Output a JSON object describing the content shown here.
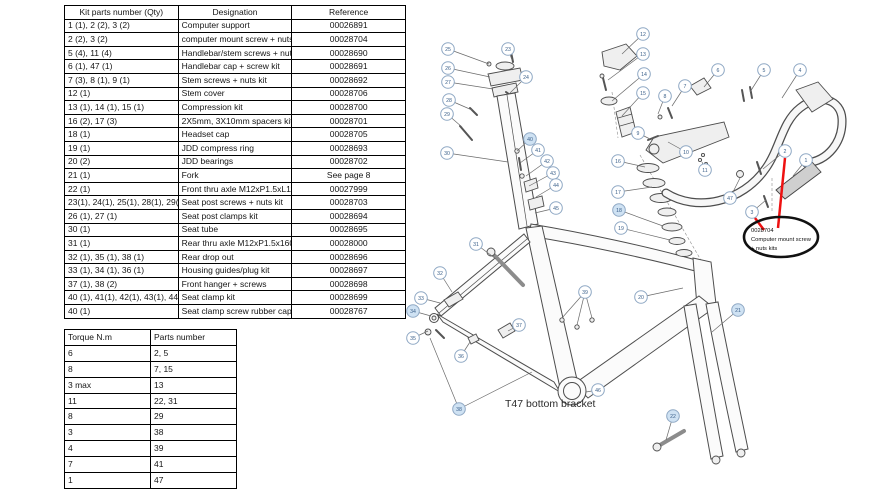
{
  "kit_table": {
    "headers": [
      "Kit parts number (Qty)",
      "Designation",
      "Reference"
    ],
    "rows": [
      [
        "1 (1), 2 (2), 3 (2)",
        "Computer support",
        "00026891"
      ],
      [
        "2 (2), 3 (2)",
        "computer mount screw + nuts kit",
        "00028704"
      ],
      [
        "5 (4), 11 (4)",
        "Handlebar/stem screws + nuts kit",
        "00028690"
      ],
      [
        "6 (1), 47 (1)",
        "Handlebar cap + screw kit",
        "00028691"
      ],
      [
        "7 (3), 8 (1), 9 (1)",
        "Stem screws + nuts kit",
        "00028692"
      ],
      [
        "12 (1)",
        "Stem cover",
        "00028706"
      ],
      [
        "13 (1), 14 (1), 15 (1)",
        "Compression kit",
        "00028700"
      ],
      [
        "16 (2), 17 (3)",
        "2X5mm, 3X10mm spacers kit",
        "00028701"
      ],
      [
        "18 (1)",
        "Headset cap",
        "00028705"
      ],
      [
        "19 (1)",
        "JDD compress ring",
        "00028693"
      ],
      [
        "20 (2)",
        "JDD bearings",
        "00028702"
      ],
      [
        "21 (1)",
        "Fork",
        "See page 8"
      ],
      [
        "22 (1)",
        "Front thru axle M12xP1.5xL115mm",
        "00027999"
      ],
      [
        "23(1), 24(1), 25(1), 28(1), 29(1)",
        "Seat post screws + nuts kit",
        "00028703"
      ],
      [
        "26 (1), 27 (1)",
        "Seat post clamps kit",
        "00028694"
      ],
      [
        "30 (1)",
        "Seat tube",
        "00028695"
      ],
      [
        "31 (1)",
        "Rear thru axle M12xP1.5x160mm",
        "00028000"
      ],
      [
        "32 (1), 35 (1), 38 (1)",
        "Rear drop out",
        "00028696"
      ],
      [
        "33 (1), 34 (1), 36 (1)",
        "Housing guides/plug kit",
        "00028697"
      ],
      [
        "37 (1), 38 (2)",
        "Front hanger + screws",
        "00028698"
      ],
      [
        "40 (1), 41(1), 42(1), 43(1), 44(1), 45(1)",
        "Seat clamp kit",
        "00028699"
      ],
      [
        "40 (1)",
        "Seat clamp screw rubber cap",
        "00028767"
      ]
    ]
  },
  "torque_table": {
    "headers": [
      "Torque N.m",
      "Parts number"
    ],
    "rows": [
      [
        "6",
        "2, 5"
      ],
      [
        "8",
        "7, 15"
      ],
      [
        "3 max",
        "13"
      ],
      [
        "11",
        "22, 31"
      ],
      [
        "8",
        "29"
      ],
      [
        "3",
        "38"
      ],
      [
        "4",
        "39"
      ],
      [
        "7",
        "41"
      ],
      [
        "1",
        "47"
      ]
    ]
  },
  "diagram": {
    "t47_label": "T47 bottom bracket",
    "annotation": {
      "code": "0028704",
      "line1": "Computer mount screw",
      "line2": "+ nuts kits"
    },
    "colors": {
      "red": "#ee1111",
      "callout_stroke": "#8fa8c4",
      "callout_text": "#3c618b",
      "callout_fill": "#ffffff",
      "callout_fill_hl": "#cfe2f3",
      "leader": "#6b6b6b"
    },
    "callouts": [
      {
        "n": "1",
        "x": 806,
        "y": 160,
        "tx": 793,
        "ty": 176
      },
      {
        "n": "2",
        "x": 785,
        "y": 151,
        "tx": 763,
        "ty": 169
      },
      {
        "n": "3",
        "x": 752,
        "y": 212,
        "tx": 766,
        "ty": 200
      },
      {
        "n": "4",
        "x": 800,
        "y": 70,
        "tx": 782,
        "ty": 98
      },
      {
        "n": "5",
        "x": 764,
        "y": 70,
        "tx": 750,
        "ty": 92
      },
      {
        "n": "6",
        "x": 718,
        "y": 70,
        "tx": 704,
        "ty": 87
      },
      {
        "n": "7",
        "x": 685,
        "y": 86,
        "tx": 672,
        "ty": 106
      },
      {
        "n": "8",
        "x": 665,
        "y": 96,
        "tx": 658,
        "ty": 114
      },
      {
        "n": "9",
        "x": 638,
        "y": 133,
        "tx": 650,
        "ty": 139
      },
      {
        "n": "10",
        "x": 686,
        "y": 152,
        "tx": 668,
        "ty": 142
      },
      {
        "n": "11",
        "x": 705,
        "y": 170,
        "tx": 702,
        "ty": 162
      },
      {
        "n": "12",
        "x": 643,
        "y": 34,
        "tx": 622,
        "ty": 54
      },
      {
        "n": "13",
        "x": 643,
        "y": 54,
        "tx": 608,
        "ty": 80
      },
      {
        "n": "14",
        "x": 644,
        "y": 74,
        "tx": 612,
        "ty": 101
      },
      {
        "n": "15",
        "x": 643,
        "y": 93,
        "tx": 622,
        "ty": 116
      },
      {
        "n": "16",
        "x": 618,
        "y": 161,
        "tx": 645,
        "ty": 167
      },
      {
        "n": "17",
        "x": 618,
        "y": 192,
        "tx": 652,
        "ty": 187
      },
      {
        "n": "18",
        "x": 619,
        "y": 210,
        "tx": 663,
        "ty": 226,
        "hl": true
      },
      {
        "n": "19",
        "x": 621,
        "y": 228,
        "tx": 670,
        "ty": 240
      },
      {
        "n": "20",
        "x": 641,
        "y": 297,
        "tx": 683,
        "ty": 288
      },
      {
        "n": "21",
        "x": 738,
        "y": 310,
        "tx": 712,
        "ty": 332,
        "hl": true
      },
      {
        "n": "22",
        "x": 673,
        "y": 416,
        "tx": 666,
        "ty": 440,
        "hl": true
      },
      {
        "n": "23",
        "x": 508,
        "y": 49,
        "tx": 512,
        "ty": 60
      },
      {
        "n": "24",
        "x": 526,
        "y": 77,
        "tx": 510,
        "ty": 93
      },
      {
        "n": "25",
        "x": 448,
        "y": 49,
        "tx": 489,
        "ty": 64
      },
      {
        "n": "26",
        "x": 448,
        "y": 68,
        "tx": 490,
        "ty": 77
      },
      {
        "n": "27",
        "x": 448,
        "y": 82,
        "tx": 493,
        "ty": 89
      },
      {
        "n": "28",
        "x": 449,
        "y": 100,
        "tx": 472,
        "ty": 110
      },
      {
        "n": "29",
        "x": 447,
        "y": 114,
        "tx": 462,
        "ty": 127
      },
      {
        "n": "30",
        "x": 447,
        "y": 153,
        "tx": 508,
        "ty": 162
      },
      {
        "n": "31",
        "x": 476,
        "y": 244,
        "tx": 496,
        "ty": 259
      },
      {
        "n": "32",
        "x": 440,
        "y": 273,
        "tx": 452,
        "ty": 292
      },
      {
        "n": "33",
        "x": 421,
        "y": 298,
        "tx": 440,
        "ty": 303
      },
      {
        "n": "34",
        "x": 413,
        "y": 311,
        "tx": 431,
        "ty": 316,
        "hl": true
      },
      {
        "n": "35",
        "x": 413,
        "y": 338,
        "tx": 428,
        "ty": 331
      },
      {
        "n": "36",
        "x": 461,
        "y": 356,
        "tx": 470,
        "ty": 342
      },
      {
        "n": "37",
        "x": 519,
        "y": 325,
        "tx": 508,
        "ty": 331
      },
      {
        "n": "38",
        "x": 459,
        "y": 409,
        "tx": 430,
        "ty": 338,
        "tx2": 532,
        "ty2": 372,
        "hl": true
      },
      {
        "n": "39",
        "x": 585,
        "y": 292,
        "tx": 562,
        "ty": 318,
        "tx2": 577,
        "ty2": 325,
        "tx3": 592,
        "ty3": 318
      },
      {
        "n": "40",
        "x": 530,
        "y": 139,
        "tx": 517,
        "ty": 151,
        "hl": true
      },
      {
        "n": "41",
        "x": 538,
        "y": 150,
        "tx": 520,
        "ty": 163
      },
      {
        "n": "42",
        "x": 547,
        "y": 161,
        "tx": 526,
        "ty": 176
      },
      {
        "n": "43",
        "x": 553,
        "y": 173,
        "tx": 529,
        "ty": 186
      },
      {
        "n": "44",
        "x": 556,
        "y": 185,
        "tx": 536,
        "ty": 197
      },
      {
        "n": "45",
        "x": 556,
        "y": 208,
        "tx": 535,
        "ty": 213
      },
      {
        "n": "46",
        "x": 598,
        "y": 390,
        "tx": 586,
        "ty": 392
      },
      {
        "n": "47",
        "x": 730,
        "y": 198,
        "tx": 740,
        "ty": 178
      }
    ]
  }
}
